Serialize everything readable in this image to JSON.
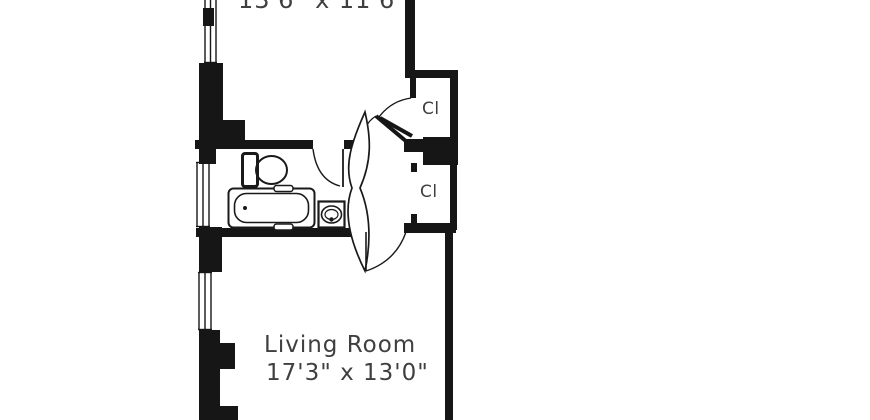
{
  "floor_plan": {
    "title": "apartment-floor-plan",
    "colors": {
      "wall": "#161616",
      "fixture_line": "#1a1a1a",
      "text": "#3f3f3f",
      "background": "#ffffff"
    },
    "rooms": {
      "bedroom": {
        "dimensions": "13'6\" x 11'6\""
      },
      "living_room": {
        "name": "Living Room",
        "dimensions": "17'3\" x 13'0\""
      },
      "bathroom": {
        "fixtures": [
          "toilet",
          "bathtub",
          "sink"
        ]
      },
      "closet_top": {
        "label": "Cl"
      },
      "closet_bottom": {
        "label": "Cl"
      }
    },
    "features": [
      "windows-left-wall",
      "door-swing-arcs",
      "hall-double-door-lens"
    ]
  }
}
